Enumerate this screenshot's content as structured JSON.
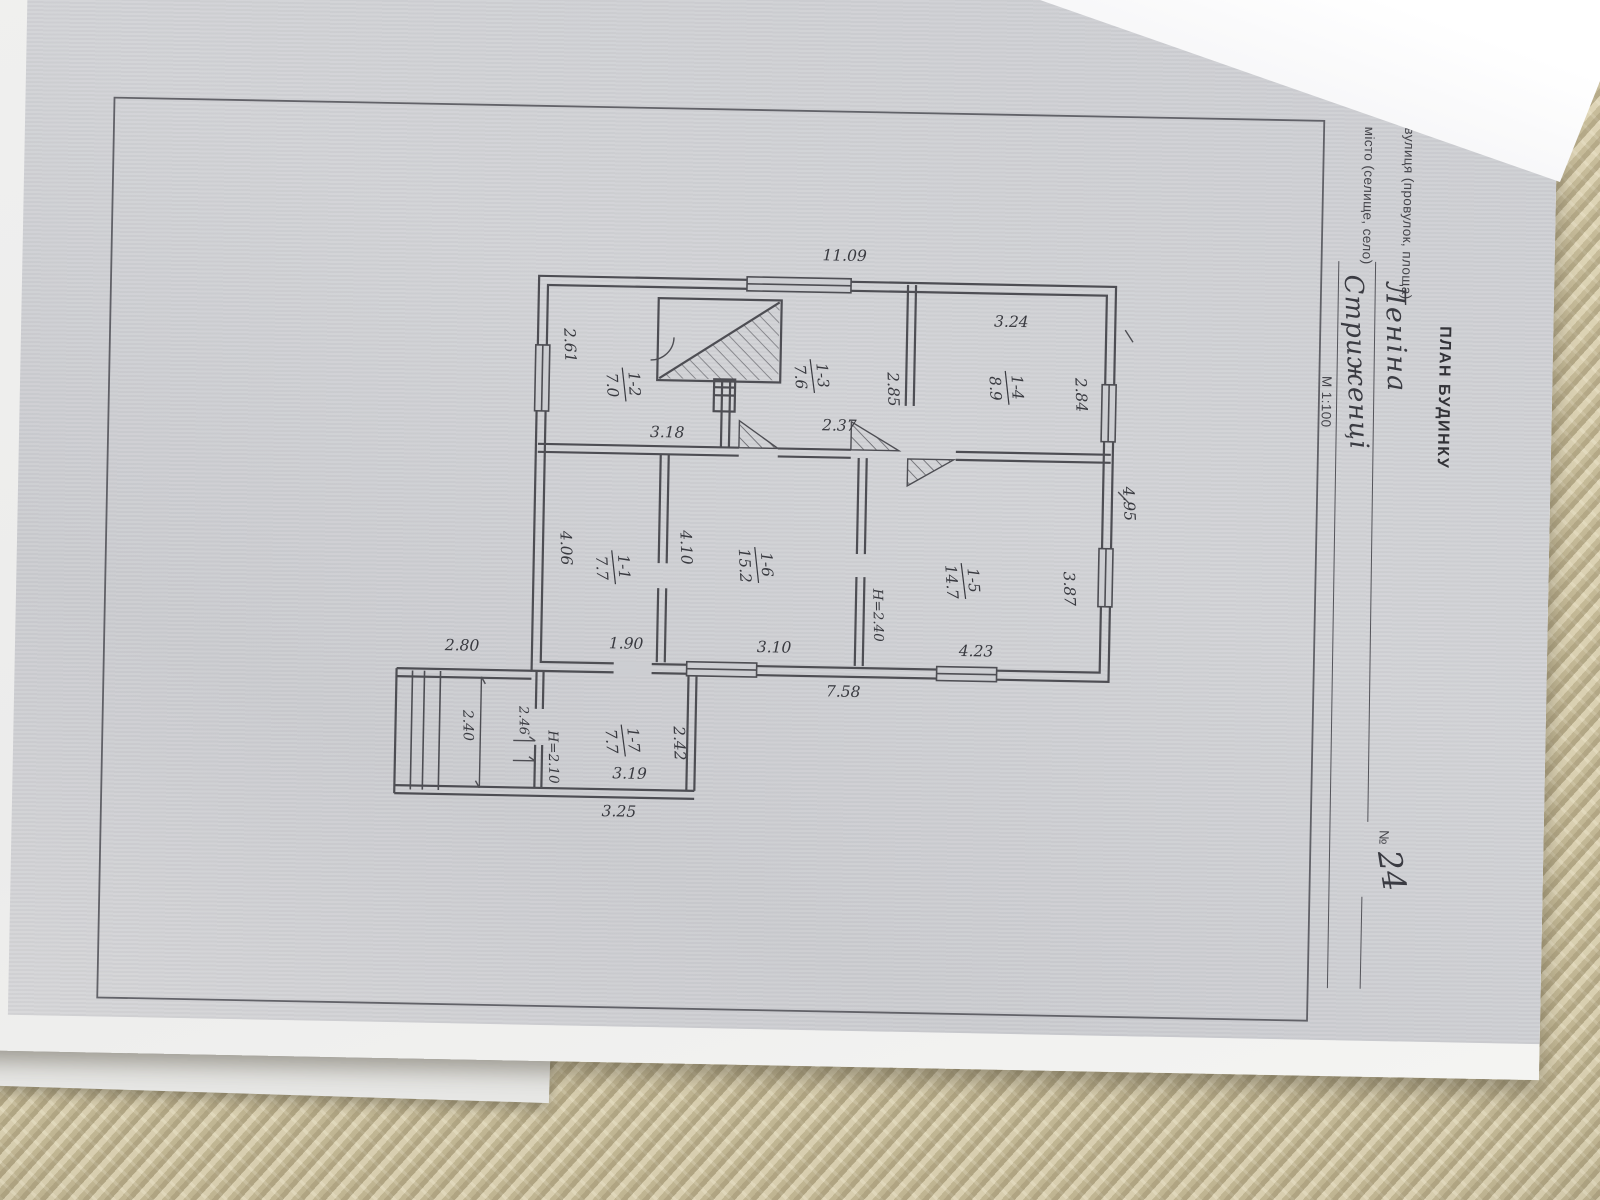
{
  "header": {
    "title": "ПЛАН БУДИНКУ",
    "street_label": "вулиця (провулок, площа)",
    "street_value": "Леніна",
    "number_label": "№",
    "number_value": "24",
    "city_label": "місто (селище, село)",
    "city_value": "Стриженці",
    "scale": "М 1:100"
  },
  "plan": {
    "overall": {
      "height_m": "11.09",
      "width_m": "7.58",
      "top_m": "4.95"
    },
    "rooms": [
      {
        "id": "1-1",
        "area": "7.7",
        "dims": [
          "4.06",
          "1.90"
        ]
      },
      {
        "id": "1-2",
        "area": "7.0",
        "dims": [
          "2.61",
          "3.18"
        ]
      },
      {
        "id": "1-3",
        "area": "7.6",
        "dims": [
          "2.85",
          "2.37"
        ]
      },
      {
        "id": "1-4",
        "area": "8.9",
        "dims": [
          "2.84",
          "3.24"
        ]
      },
      {
        "id": "1-5",
        "area": "14.7",
        "dims": [
          "3.87",
          "4.23"
        ],
        "height": "Н=2.40"
      },
      {
        "id": "1-6",
        "area": "15.2",
        "dims": [
          "4.10",
          "3.10"
        ]
      },
      {
        "id": "1-7",
        "area": "7.7",
        "dims": [
          "2.42",
          "3.19"
        ],
        "height": "Н=2.10"
      }
    ],
    "annex": {
      "porch_len": "2.80",
      "width": "2.40",
      "offset": "2.46",
      "outer_len": "3.25"
    }
  }
}
